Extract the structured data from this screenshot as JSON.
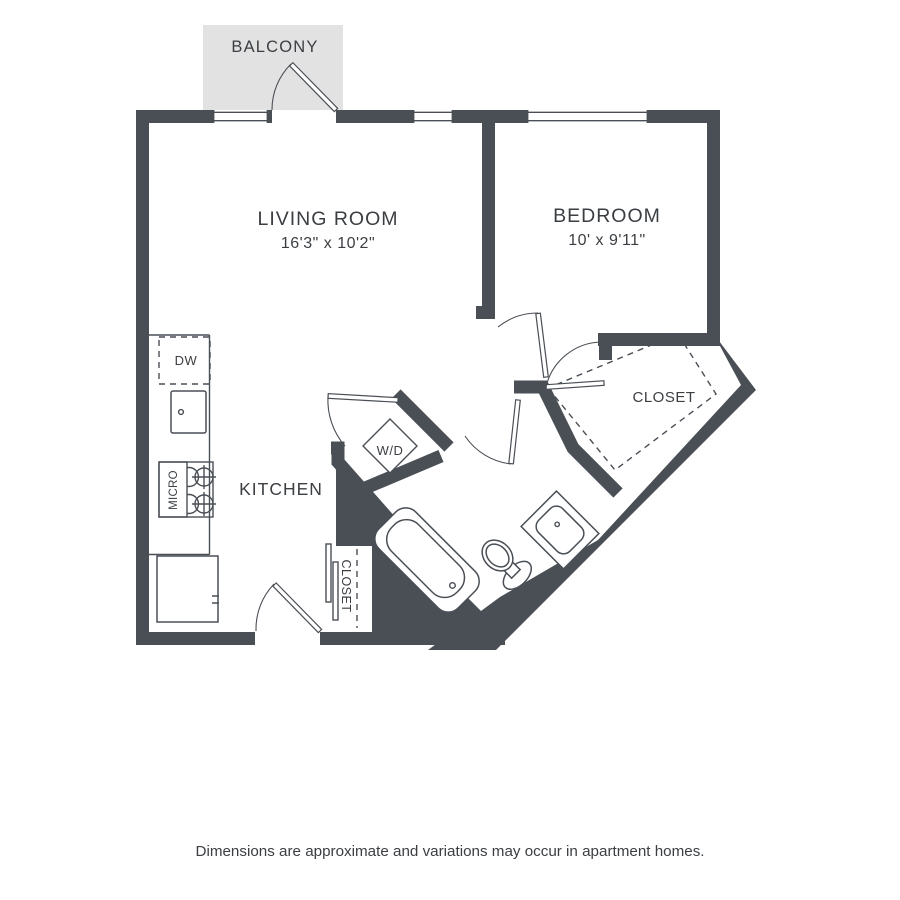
{
  "plan": {
    "balcony": {
      "label": "BALCONY"
    },
    "living_room": {
      "label": "LIVING ROOM",
      "dimensions": "16'3\" x 10'2\""
    },
    "bedroom": {
      "label": "BEDROOM",
      "dimensions": "10' x 9'11\""
    },
    "kitchen": {
      "label": "KITCHEN",
      "dishwasher_label": "DW",
      "microwave_label": "MICRO"
    },
    "laundry": {
      "label": "W/D"
    },
    "bedroom_closet": {
      "label": "CLOSET"
    },
    "entry_closet": {
      "label": "CLOSET"
    }
  },
  "footer": {
    "disclaimer": "Dimensions are approximate and variations may occur in apartment homes."
  },
  "colors": {
    "wall": "#4a4f56",
    "balcony_fill": "#e2e2e3",
    "text": "#3b3e42",
    "background": "#ffffff"
  }
}
